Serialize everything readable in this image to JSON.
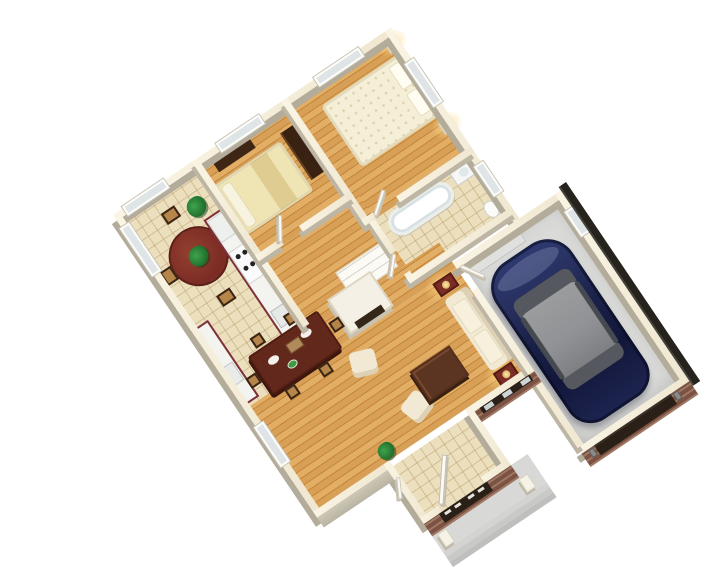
{
  "scene": {
    "type": "isometric-3d-floorplan-render",
    "view": "birds-eye dollhouse view of a one-story house, rotated about 34 degrees, white background",
    "rooms": [
      {
        "name": "breakfast-nook",
        "floor": "tile",
        "items": [
          "round-table",
          "4-chairs",
          "potted-plant",
          "bay-window"
        ]
      },
      {
        "name": "kitchen",
        "floor": "tile",
        "items": [
          "maroon-cabinet-run",
          "white-counter",
          "stove-with-burners",
          "sink"
        ]
      },
      {
        "name": "bedroom-2",
        "floor": "hardwood",
        "items": [
          "bed-yellow-bedding",
          "dark-dresser",
          "dark-wardrobe",
          "window"
        ]
      },
      {
        "name": "master-bedroom",
        "floor": "hardwood",
        "items": [
          "large-bed-floral-bedding",
          "two-nightstands",
          "gold-lamps",
          "windows"
        ]
      },
      {
        "name": "bathroom",
        "floor": "tile",
        "items": [
          "bathtub",
          "vanity-sink",
          "toilet",
          "window"
        ]
      },
      {
        "name": "hallway",
        "floor": "hardwood",
        "items": [
          "linen-closet",
          "white-doors"
        ]
      },
      {
        "name": "living-dining-room",
        "floor": "hardwood",
        "items": [
          "fireplace",
          "dining-table",
          "6-chairs",
          "sofa",
          "2-armchairs",
          "coffee-table",
          "2-end-tables-with-lit-lamps",
          "floor-plant"
        ]
      },
      {
        "name": "foyer",
        "floor": "tile",
        "items": [
          "open-front-door",
          "closet"
        ]
      },
      {
        "name": "front-porch",
        "floor": "concrete",
        "items": [
          "2-white-columns",
          "steps",
          "brick-facade",
          "dark-transom-band"
        ]
      },
      {
        "name": "garage",
        "floor": "concrete",
        "items": [
          "navy-sedan",
          "entry-step",
          "recessed-garage-door",
          "coach-lamps",
          "window"
        ]
      }
    ],
    "vehicle": {
      "type": "sedan",
      "body_color": "#27305f",
      "roof_color": "#909295"
    },
    "exterior": {
      "siding": "cream-cut-walls",
      "masonry": "red-brown-brick",
      "roof_edge": "dark-charcoal-strip",
      "porch_columns": 2
    }
  },
  "palette": {
    "bg": "#ffffff",
    "wood1": "#d89f56",
    "wood2": "#e2ad64",
    "wood3": "#c2853a",
    "tile": "#ecdfbe",
    "tileLine": "rgba(171,141,84,0.40)",
    "conc": "#dadbd9",
    "porch": "#d8d8d6",
    "wallTop1": "#faf4e4",
    "wallTop2": "#efe7d0",
    "wallFace": "#bdb6a5",
    "wallFaceExt": "#b3ac9b",
    "brick": "#7c5244",
    "brickLite": "rgba(236,206,168,0.30)",
    "maroon": "#7c3038",
    "counter": "#f3f3ef",
    "burg": "#7b2c24",
    "mahog": "#63281c",
    "cream": "#f1e9d4",
    "creamDk": "#ddd1b5",
    "bedYellow": "#efe4b4",
    "bedWhite": "#f5efd8",
    "darkwood": "#3f2514",
    "navy": "#27305f",
    "navyDk": "#141a38",
    "carRoof": "#909295",
    "carGlass": "#55585e",
    "glass": "#dfe5e6",
    "frame": "#fdfdfb",
    "doorW": "#fbfaf6",
    "darkOpen": "#2a2017",
    "roof": "#26231d",
    "green": "#1f6d2b",
    "gold": "#c9a23c",
    "glow": "rgba(255,216,130,0.85)"
  }
}
